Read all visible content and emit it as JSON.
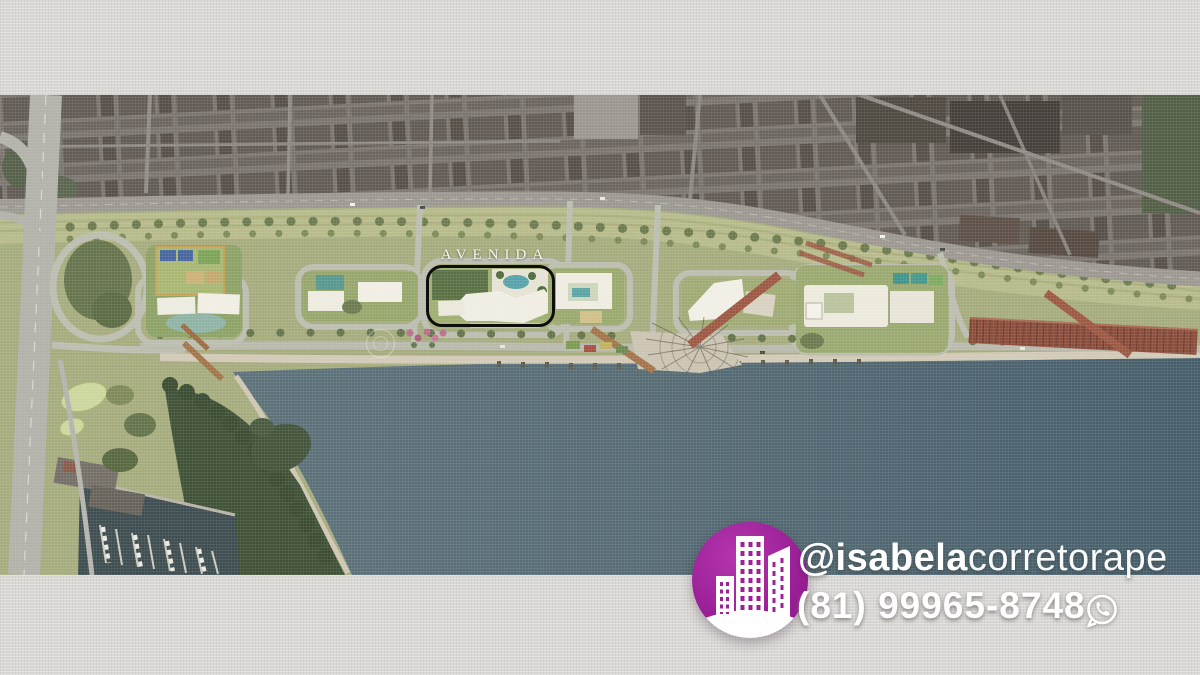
{
  "overlay": {
    "project_label": "AVENIDA"
  },
  "contact": {
    "handle_bold": "@isabela",
    "handle_light": "corretorape",
    "phone_number": "(81) 99965-8748"
  },
  "branding": {
    "accent_purple": "#9c2097",
    "text_color": "#ffffff",
    "logo_icon": "buildings-icon",
    "whatsapp_icon": "whatsapp-icon"
  },
  "map": {
    "background_texture_color": "#dad8d5",
    "water_color": "#52666f",
    "park_color": "#a6ac7d",
    "urban_color": "#7b756f",
    "highlight_outline_color": "#0e0e0d",
    "highlighted_site": "avenida-development-site"
  }
}
